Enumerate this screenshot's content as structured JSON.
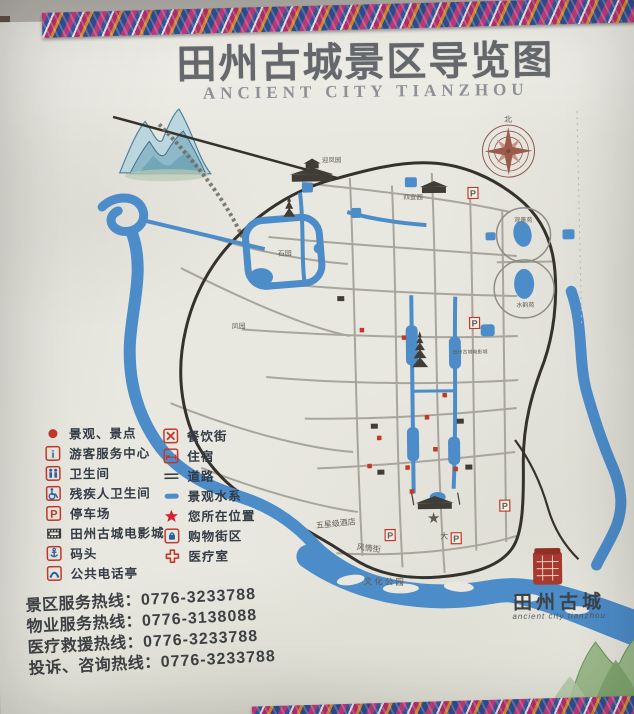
{
  "title": {
    "zh": "田州古城景区导览图",
    "en": "ANCIENT CITY TIANZHOU"
  },
  "legend": {
    "left": [
      {
        "icon": "scenic-spot-dot",
        "label": "景观、景点"
      },
      {
        "icon": "visitor-center-info",
        "label": "游客服务中心"
      },
      {
        "icon": "toilet",
        "label": "卫生间"
      },
      {
        "icon": "accessible-toilet",
        "label": "残疾人卫生间"
      },
      {
        "icon": "parking",
        "label": "停车场"
      },
      {
        "icon": "cinema-film",
        "label": "田州古城电影城"
      },
      {
        "icon": "wharf-anchor",
        "label": "码头"
      },
      {
        "icon": "public-phone",
        "label": "公共电话亭"
      }
    ],
    "right": [
      {
        "icon": "dining-cross",
        "label": "餐饮街"
      },
      {
        "icon": "lodging-bed",
        "label": "住宿"
      },
      {
        "icon": "road-lines",
        "label": "道路"
      },
      {
        "icon": "water-bar",
        "label": "景观水系"
      },
      {
        "icon": "location-star",
        "label": "您所在位置"
      },
      {
        "icon": "shopping-bag",
        "label": "购物街区"
      },
      {
        "icon": "medical-cross",
        "label": "医疗室"
      }
    ]
  },
  "hotlines": [
    {
      "label": "景区服务热线：",
      "number": "0776-3233788"
    },
    {
      "label": "物业服务热线：",
      "number": "0776-3138088"
    },
    {
      "label": "医疗救援热线：",
      "number": "0776-3233788"
    },
    {
      "label": "投诉、咨询热线：",
      "number": "0776-3233788"
    }
  ],
  "brand": {
    "name": "田州古城",
    "script": "ancient city tianzhou"
  },
  "map": {
    "p": "P",
    "star": "★",
    "compass_north": "北",
    "labels": [
      {
        "text": "迎凤园"
      },
      {
        "text": "四宜园"
      },
      {
        "text": "石园"
      },
      {
        "text": "凤园"
      },
      {
        "text": "观景苑"
      },
      {
        "text": "水韵苑"
      },
      {
        "text": "五星级酒店"
      },
      {
        "text": "风情街"
      },
      {
        "text": "文化公园"
      },
      {
        "text": "田州古城电影城"
      },
      {
        "text": "大"
      }
    ]
  },
  "colors": {
    "water": "#4c8cc9",
    "marker_red": "#c0392b",
    "road_gray": "#a5a29a",
    "boundary_black": "#35322c",
    "title_gray": "#65686c"
  }
}
